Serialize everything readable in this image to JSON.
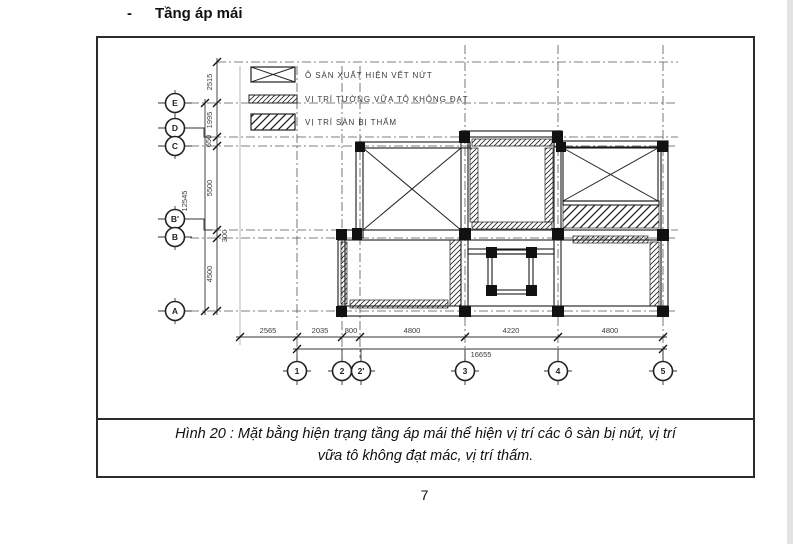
{
  "page": {
    "heading_bullet": "-",
    "heading": "Tầng áp mái",
    "page_number": "7",
    "caption_line1": "Hình 20 : Mặt bằng hiện trạng tầng áp mái thể hiện vị trí các ô sàn bị nứt, vị trí",
    "caption_line2": "vữa tô không đạt mác, vị trí thấm."
  },
  "legend": {
    "items": [
      {
        "symbol": "x-cross-panel",
        "label": "Ô SÀN XUẤT HIỆN VẾT NỨT"
      },
      {
        "symbol": "thin-hatch-strip",
        "label": "VỊ TRÍ TƯỜNG VỮA TÔ KHÔNG ĐẠT"
      },
      {
        "symbol": "hatch-panel",
        "label": "VỊ TRÍ SÀN BỊ THẤM"
      }
    ]
  },
  "axes": {
    "rows": [
      "E",
      "D",
      "C",
      "B'",
      "B",
      "A"
    ],
    "cols": [
      "1",
      "2",
      "2'",
      "3",
      "4",
      "5"
    ]
  },
  "dimensions": {
    "vertical": [
      "2515",
      "1995",
      "650",
      "5500",
      "300",
      "4500"
    ],
    "vertical_total": "12545",
    "horizontal": [
      "2565",
      "2035",
      "800",
      "4800",
      "4220",
      "4800"
    ],
    "horizontal_total": "16655"
  },
  "colors": {
    "line": "#1a1a1a",
    "grid": "#555555",
    "frame": "#2b2b2b",
    "background": "#ffffff"
  }
}
